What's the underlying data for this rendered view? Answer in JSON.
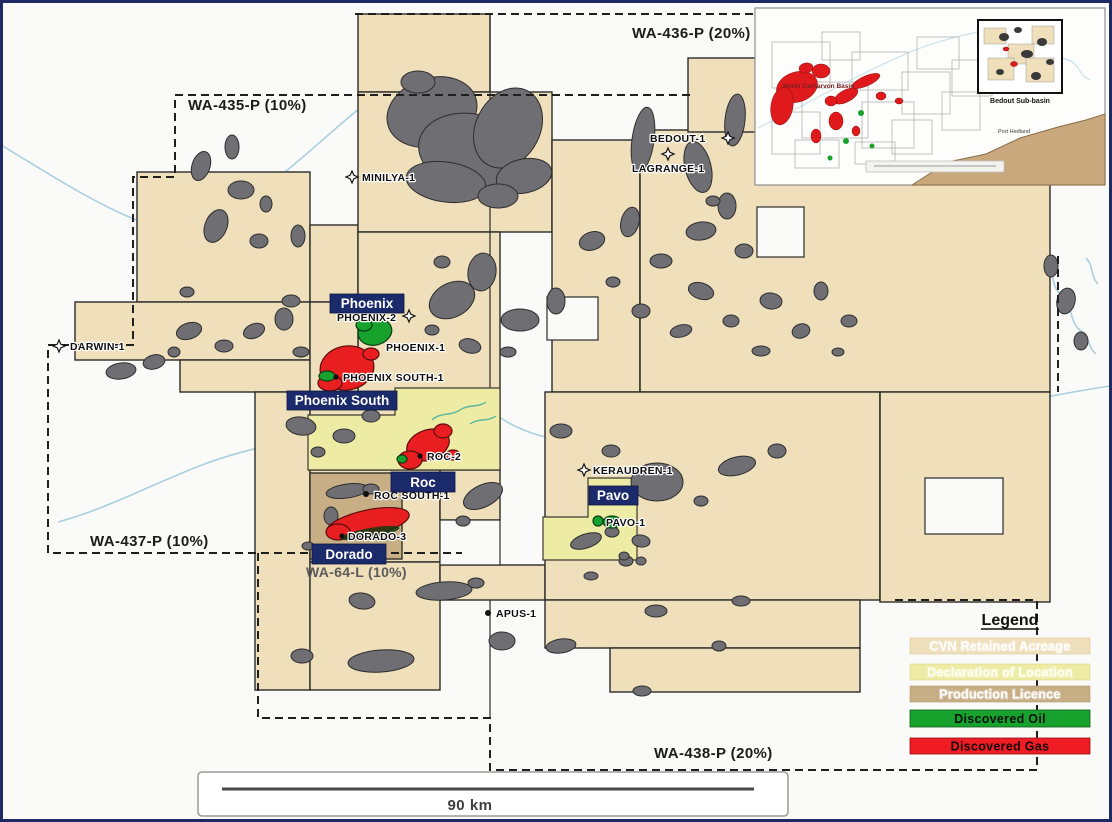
{
  "permits": [
    {
      "label": "WA-435-P (10%)"
    },
    {
      "label": "WA-436-P (20%)"
    },
    {
      "label": "WA-437-P (10%)"
    },
    {
      "label": "WA-438-P (20%)"
    },
    {
      "label": "WA-64-L (10%)"
    }
  ],
  "fields": [
    {
      "name": "Phoenix",
      "type": "oil"
    },
    {
      "name": "Phoenix South",
      "type": "gas"
    },
    {
      "name": "Roc",
      "type": "gas"
    },
    {
      "name": "Dorado",
      "type": "gas"
    },
    {
      "name": "Pavo",
      "type": "oil"
    }
  ],
  "wells": [
    {
      "label": "MINILYA-1"
    },
    {
      "label": "DARWIN-1"
    },
    {
      "label": "BEDOUT-1"
    },
    {
      "label": "LAGRANGE-1"
    },
    {
      "label": "PHOENIX-2"
    },
    {
      "label": "PHOENIX-1"
    },
    {
      "label": "PHOENIX SOUTH-1"
    },
    {
      "label": "ROC-2"
    },
    {
      "label": "ROC SOUTH-1"
    },
    {
      "label": "DORADO-3"
    },
    {
      "label": "KERAUDREN-1"
    },
    {
      "label": "PAVO-1"
    },
    {
      "label": "APUS-1"
    }
  ],
  "contours": {
    "c200": "200m",
    "c100": "100m"
  },
  "scale_bar": {
    "label": "90 km"
  },
  "inset": {
    "basin_label": "North Carnarvon Basin",
    "box_label": "Bedout Sub-basin",
    "coast_label": "Port Hedland"
  },
  "legend": {
    "title": "Legend",
    "items": [
      {
        "label": "CVN Retained Acreage",
        "color": "#efdfba",
        "text_color": "#ffffff"
      },
      {
        "label": "Declaration of Location",
        "color": "#eeeca4",
        "text_color": "#fffef2"
      },
      {
        "label": "Production Licence",
        "color": "#c8ae85",
        "text_color": "#ffffff"
      },
      {
        "label": "Discovered Oil",
        "color": "#17a22e",
        "text_color": "#0a100a"
      },
      {
        "label": "Discovered Gas",
        "color": "#ef1c24",
        "text_color": "#140608"
      }
    ]
  },
  "colors": {
    "acreage": "#efdfba",
    "declaration": "#eeeca4",
    "production_licence": "#c8ae85",
    "oil": "#17a22e",
    "gas": "#e81e20",
    "field_label_bg": "#1b2a6b",
    "ocean": "#fafaf8",
    "feature_gray": "#6f6f73",
    "contour_blue": "#aacfdf",
    "coast_brown": "#c9a87e"
  }
}
